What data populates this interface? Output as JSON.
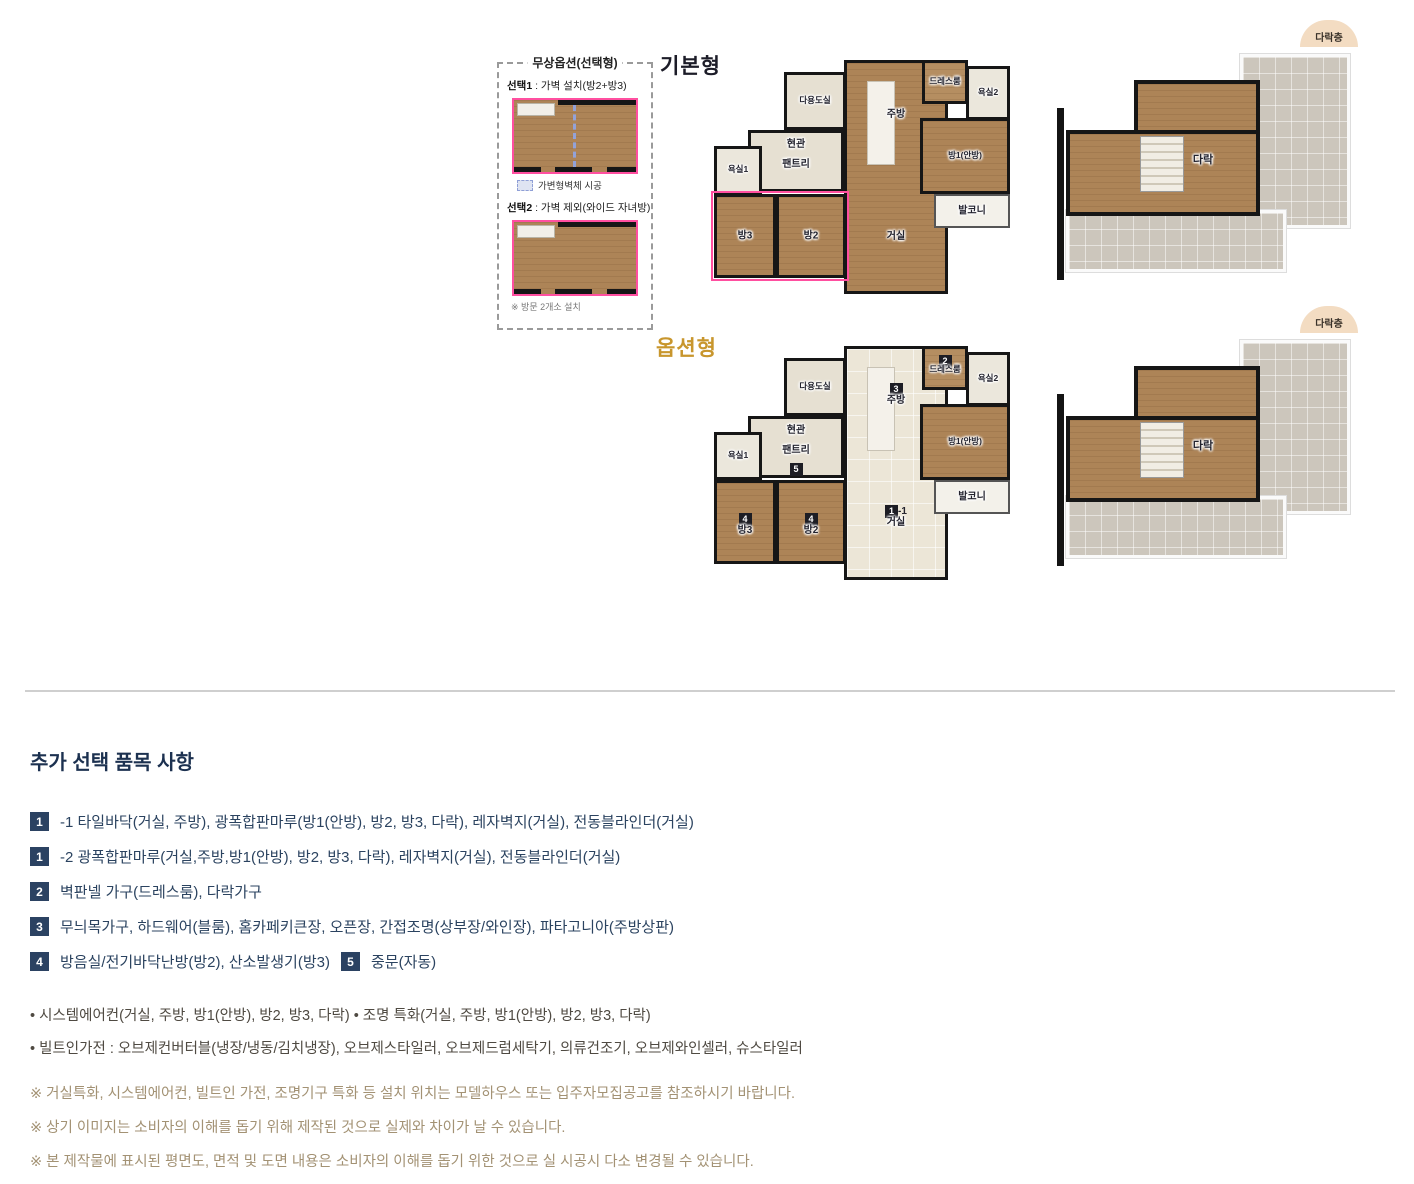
{
  "option_panel": {
    "title": "무상옵션(선택형)",
    "choice1_label": "선택1",
    "choice1_desc": " : 가벽 설치(방2+방3)",
    "legend": "가변형벽체 시공",
    "choice2_label": "선택2",
    "choice2_desc": " : 가벽 제외(와이드 자녀방)",
    "note": "※ 방문 2개소 설치"
  },
  "basic_plan": {
    "title": "기본형",
    "rooms": {
      "utility": "다용도실",
      "entrance": "현관",
      "pantry": "팬트리",
      "bath1": "욕실1",
      "room3": "방3",
      "room2": "방2",
      "living": "거실",
      "kitchen": "주방",
      "dress": "드레스룸",
      "bath2": "욕실2",
      "master": "방1(안방)",
      "balcony": "발코니"
    }
  },
  "option_plan": {
    "title": "옵션형",
    "rooms": {
      "utility": "다용도실",
      "entrance": "현관",
      "pantry": "팬트리",
      "bath1": "욕실1",
      "room3": "방3",
      "room2": "방2",
      "living": "거실",
      "kitchen": "주방",
      "dress": "드레스룸",
      "bath2": "욕실2",
      "master": "방1(안방)",
      "balcony": "발코니"
    },
    "badges": {
      "dress": "2",
      "kitchen": "3",
      "pantry": "5",
      "room3": "4",
      "room2": "4",
      "living": "1",
      "living_suffix": "-1"
    }
  },
  "attic_plan": {
    "corner_badge": "다락층",
    "room": "다락"
  },
  "details": {
    "heading": "추가 선택 품목 사항",
    "items": [
      {
        "badge": "1",
        "text": "-1 타일바닥(거실, 주방), 광폭합판마루(방1(안방), 방2, 방3, 다락), 레자벽지(거실), 전동블라인더(거실)"
      },
      {
        "badge": "1",
        "text": "-2 광폭합판마루(거실,주방,방1(안방), 방2, 방3, 다락), 레자벽지(거실), 전동블라인더(거실)"
      },
      {
        "badge": "2",
        "text": "벽판넬 가구(드레스룸), 다락가구"
      },
      {
        "badge": "3",
        "text": "무늬목가구, 하드웨어(블룸), 홈카페키큰장, 오픈장, 간접조명(상부장/와인장), 파타고니아(주방상판)"
      },
      {
        "badge": "4",
        "text": "방음실/전기바닥난방(방2), 산소발생기(방3)",
        "badge2": "5",
        "text2": "중문(자동)"
      }
    ],
    "bullets": [
      "• 시스템에어컨(거실, 주방, 방1(안방), 방2, 방3, 다락) • 조명 특화(거실, 주방, 방1(안방), 방2, 방3, 다락)",
      "• 빌트인가전 : 오브제컨버터블(냉장/냉동/김치냉장), 오브제스타일러, 오브제드럼세탁기, 의류건조기, 오브제와인셀러, 슈스타일러"
    ],
    "notes": [
      "※ 거실특화, 시스템에어컨, 빌트인 가전, 조명기구 특화 등 설치 위치는 모델하우스 또는 입주자모집공고를 참조하시기 바랍니다.",
      "※ 상기 이미지는 소비자의 이해를 돕기 위해 제작된 것으로 실제와 차이가 날 수 있습니다.",
      "※ 본 제작물에 표시된 평면도, 면적 및 도면 내용은 소비자의 이해를 돕기 위한 것으로 실 시공시 다소 변경될 수 있습니다."
    ]
  }
}
